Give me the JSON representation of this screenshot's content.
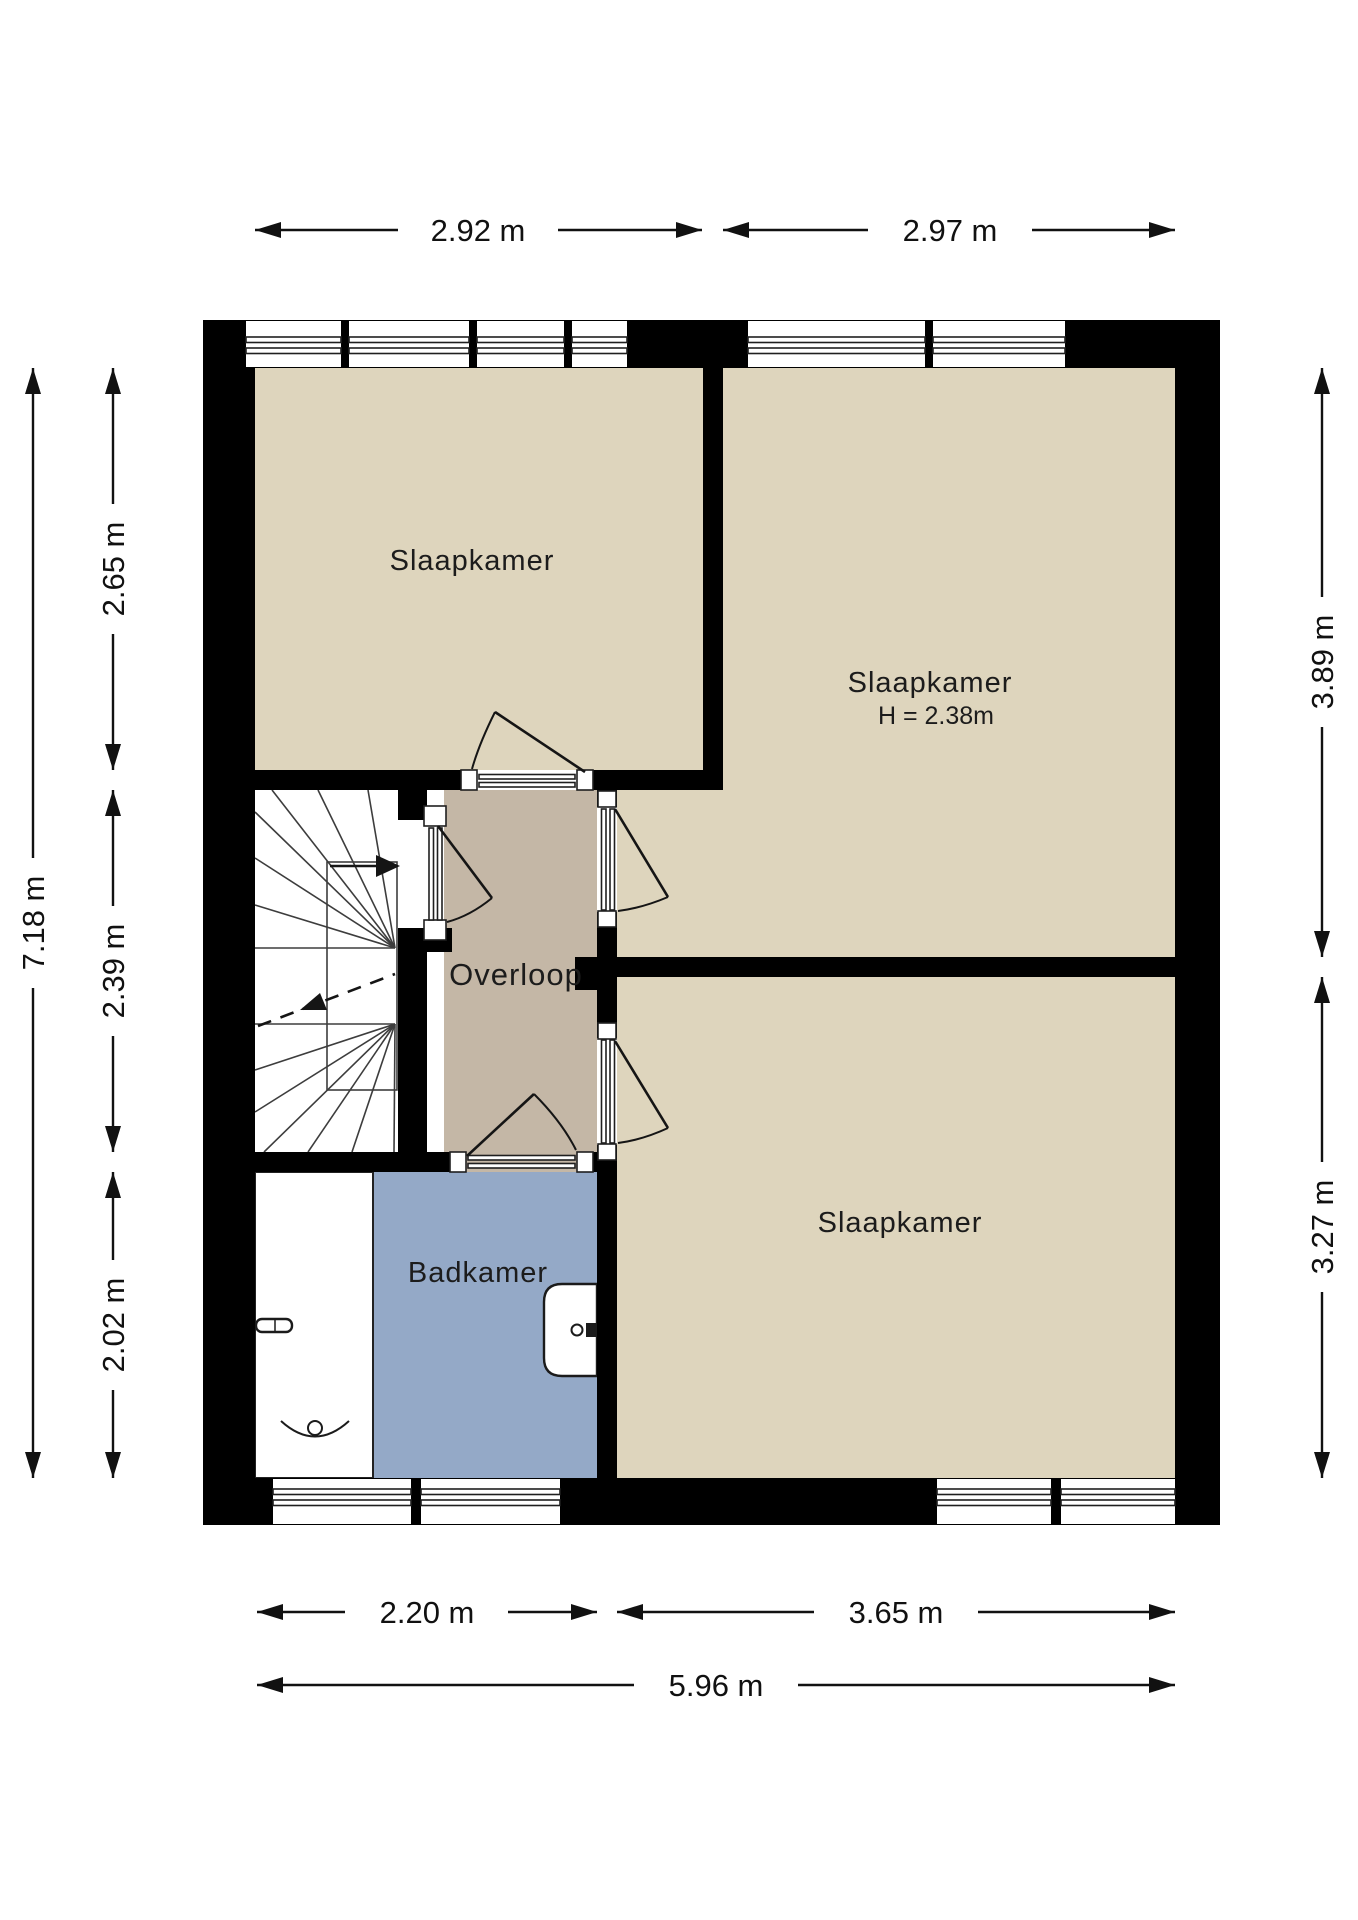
{
  "plan": {
    "rooms": {
      "bedroom_top_left": {
        "label": "Slaapkamer"
      },
      "bedroom_right": {
        "label": "Slaapkamer",
        "height_note": "H = 2.38m"
      },
      "bedroom_bottom_right": {
        "label": "Slaapkamer"
      },
      "landing": {
        "label": "Overloop"
      },
      "bathroom": {
        "label": "Badkamer"
      }
    },
    "dimensions": {
      "top_left_width": {
        "label": "2.92 m"
      },
      "top_right_width": {
        "label": "2.97 m"
      },
      "bottom_left_width": {
        "label": "2.20 m"
      },
      "bottom_right_width": {
        "label": "3.65 m"
      },
      "bottom_total_width": {
        "label": "5.96 m"
      },
      "left_total_height": {
        "label": "7.18 m"
      },
      "left_top_height": {
        "label": "2.65 m"
      },
      "left_middle_height": {
        "label": "2.39 m"
      },
      "left_bottom_height": {
        "label": "2.02 m"
      },
      "right_top_height": {
        "label": "3.89 m"
      },
      "right_bottom_height": {
        "label": "3.27 m"
      }
    },
    "colors": {
      "wall": "#000000",
      "bedroom_floor": "#ded5bd",
      "landing_floor": "#c4b7a6",
      "bathroom_floor": "#94a9c7",
      "stair_floor": "#ffffff"
    }
  }
}
